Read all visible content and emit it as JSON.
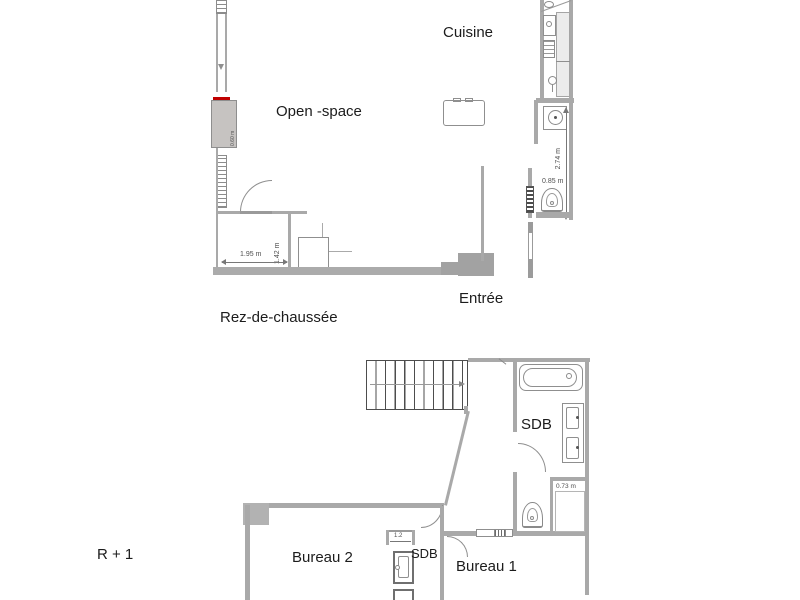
{
  "colors": {
    "wall": "#a9a9a9",
    "fixture_stroke": "#8f8f8f",
    "accent_red": "#c00000",
    "text": "#1c1c1c",
    "dim_text": "#4f4f4f"
  },
  "ground_floor": {
    "label": "Rez-de-chaussée",
    "rooms": {
      "cuisine": "Cuisine",
      "open_space": "Open -space",
      "entree": "Entrée"
    },
    "dimensions": {
      "back_width": "1.95 m",
      "back_depth": "1.42 m",
      "corridor_height": "2.74 m",
      "wc_width": "0.85 m",
      "unit_depth": "0.60 m"
    }
  },
  "first_floor": {
    "label": "R + 1",
    "rooms": {
      "bureau2": "Bureau 2",
      "bureau1": "Bureau 1",
      "sdb_main": "SDB",
      "sdb_small": "SDB"
    },
    "dimensions": {
      "closet_width": "0.73 m",
      "sdb_small_width": "1.2"
    }
  },
  "fixtures": [
    "stairs",
    "bathtub",
    "vanity-double-sink",
    "toilet",
    "washing-machine",
    "kitchen-sink",
    "corner-sink",
    "hob",
    "radiator",
    "shower",
    "desk",
    "door",
    "window"
  ]
}
